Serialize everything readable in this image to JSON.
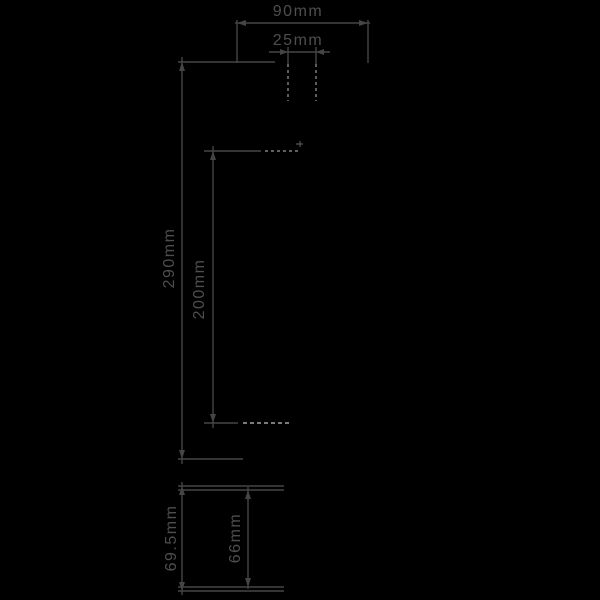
{
  "drawing": {
    "title": "dimension-drawing",
    "front_view": {
      "width_label": "90mm",
      "fixing_centres_label": "25mm",
      "overall_height_label": "290mm",
      "inner_height_label": "200mm"
    },
    "side_view": {
      "overall_depth_label": "69.5mm",
      "body_depth_label": "66mm"
    }
  },
  "colors": {
    "bg": "#000000",
    "line": "#454545",
    "label": "#4e4e4e",
    "dash": "#9a9a9a",
    "bright": "#c4c4c4",
    "faint": "#585858"
  }
}
